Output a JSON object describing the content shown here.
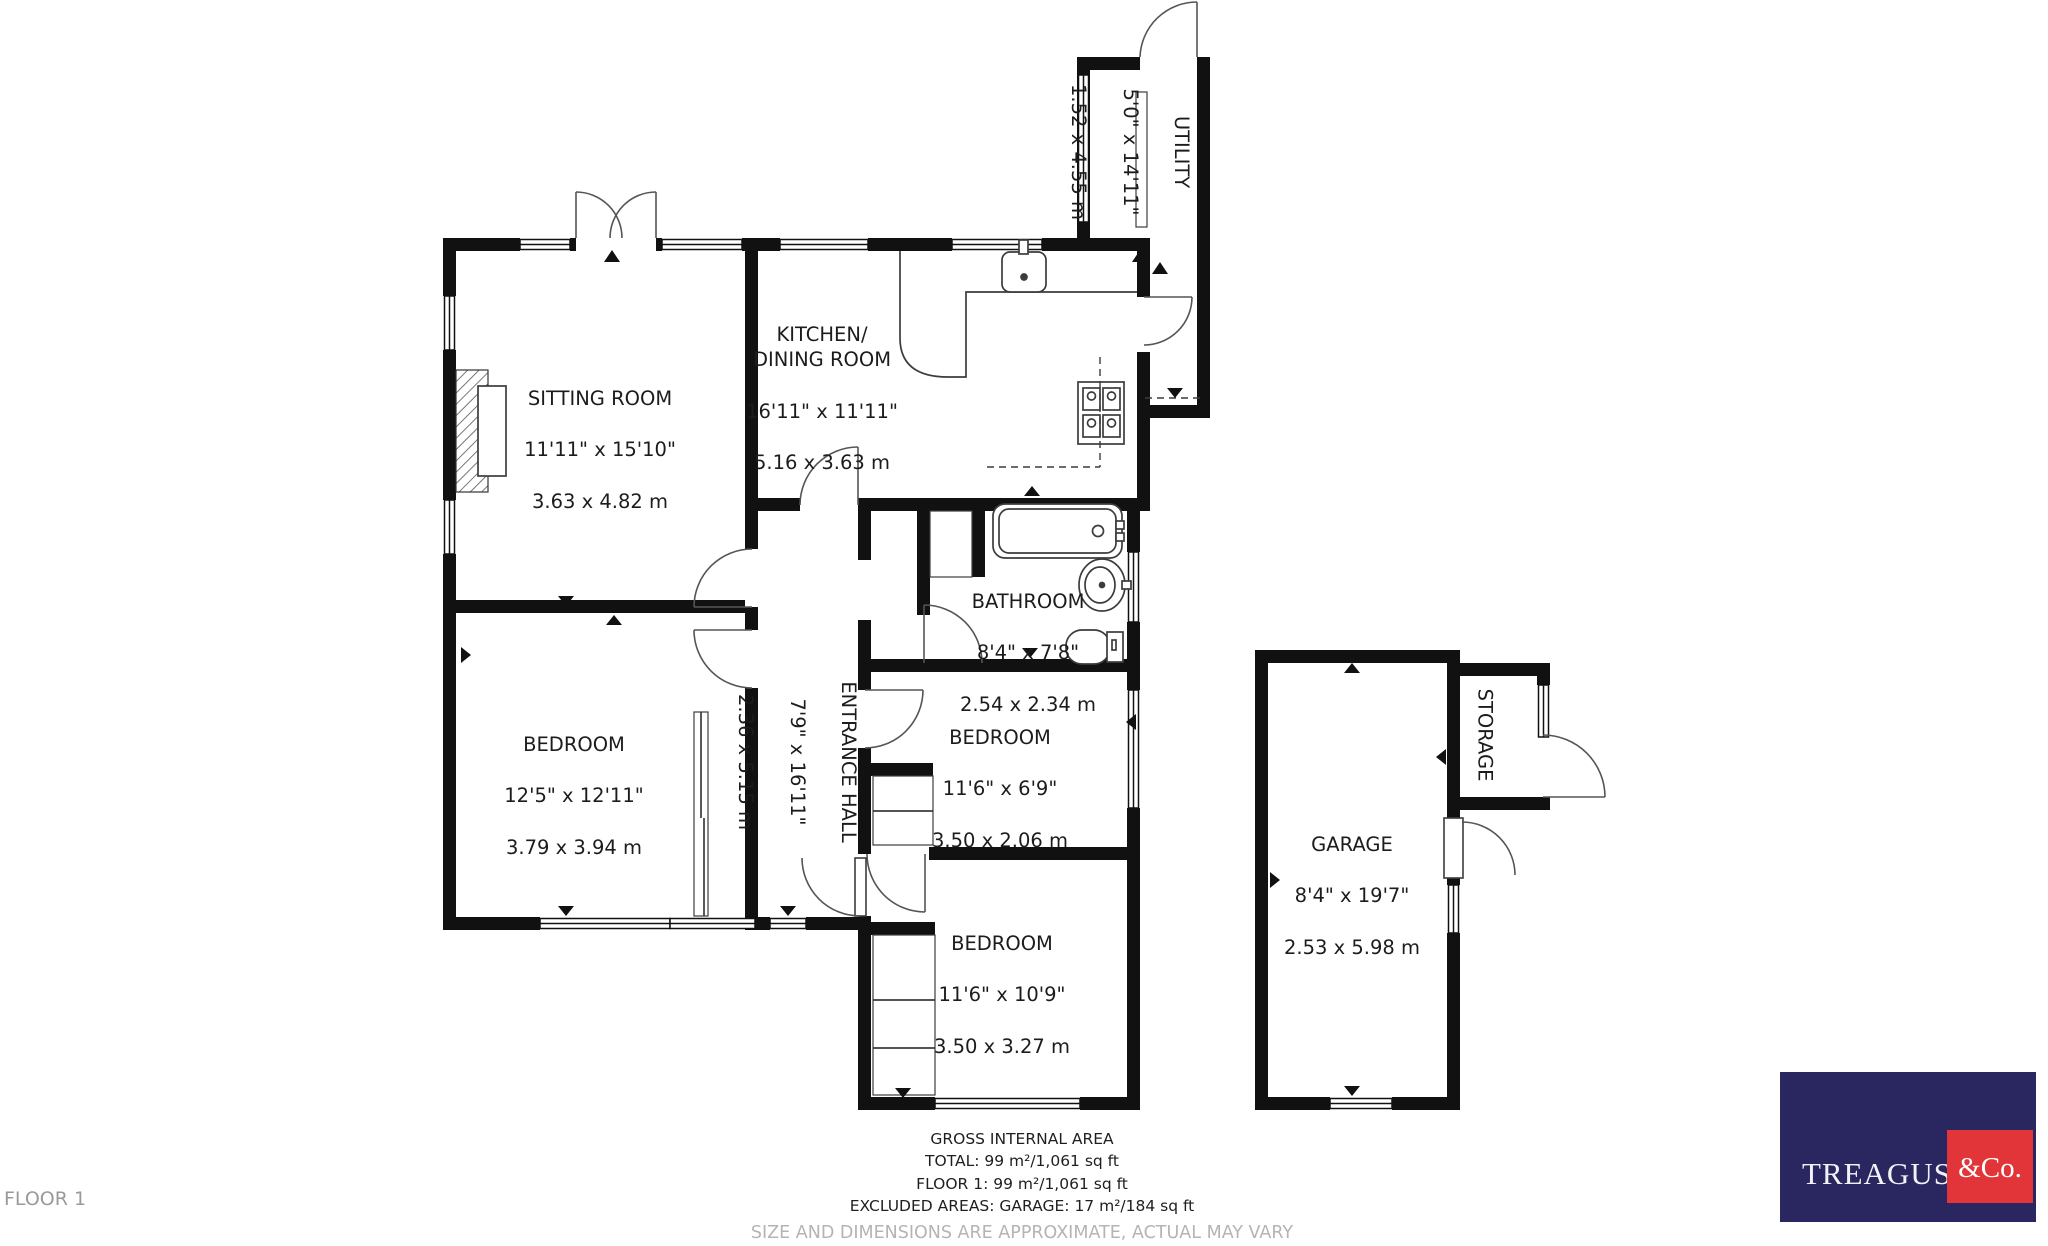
{
  "rooms": [
    {
      "id": "sitting-room",
      "name": "SITTING ROOM",
      "imperial": "11'11\" x 15'10\"",
      "metric": "3.63 x 4.82 m"
    },
    {
      "id": "kitchen-dining",
      "name": "KITCHEN/\nDINING ROOM",
      "imperial": "16'11\" x 11'11\"",
      "metric": "5.16 x 3.63 m"
    },
    {
      "id": "utility",
      "name": "UTILITY",
      "imperial": "5'0\" x 14'11\"",
      "metric": "1.52 x 4.55 m"
    },
    {
      "id": "bathroom",
      "name": "BATHROOM",
      "imperial": "8'4\" x 7'8\"",
      "metric": "2.54 x 2.34 m"
    },
    {
      "id": "entrance-hall",
      "name": "ENTRANCE HALL",
      "imperial": "7'9\" x 16'11\"",
      "metric": "2.36 x 5.15 m"
    },
    {
      "id": "bedroom-1",
      "name": "BEDROOM",
      "imperial": "12'5\" x 12'11\"",
      "metric": "3.79 x 3.94 m"
    },
    {
      "id": "bedroom-2",
      "name": "BEDROOM",
      "imperial": "11'6\" x 6'9\"",
      "metric": "3.50 x 2.06 m"
    },
    {
      "id": "bedroom-3",
      "name": "BEDROOM",
      "imperial": "11'6\" x 10'9\"",
      "metric": "3.50 x 3.27 m"
    },
    {
      "id": "garage",
      "name": "GARAGE",
      "imperial": "8'4\" x 19'7\"",
      "metric": "2.53 x 5.98 m"
    },
    {
      "id": "storage",
      "name": "STORAGE",
      "imperial": "",
      "metric": ""
    }
  ],
  "footer": {
    "heading": "GROSS INTERNAL AREA",
    "total": "TOTAL: 99 m²/1,061 sq ft",
    "floor": "FLOOR 1: 99 m²/1,061 sq ft",
    "excluded": "EXCLUDED AREAS: GARAGE: 17 m²/184 sq ft",
    "disclaimer": "SIZE AND DIMENSIONS ARE APPROXIMATE, ACTUAL MAY VARY"
  },
  "floor_label": "FLOOR 1",
  "logo": {
    "brand": "TREAGUST",
    "suffix": "&Co.",
    "navy": "#2a265f",
    "red": "#e23539"
  },
  "colors": {
    "wall": "#111111",
    "line": "#4a4a4a",
    "text": "#1c1c1c",
    "muted": "#9a9a9a",
    "disclaimer": "#b4b4b4"
  }
}
